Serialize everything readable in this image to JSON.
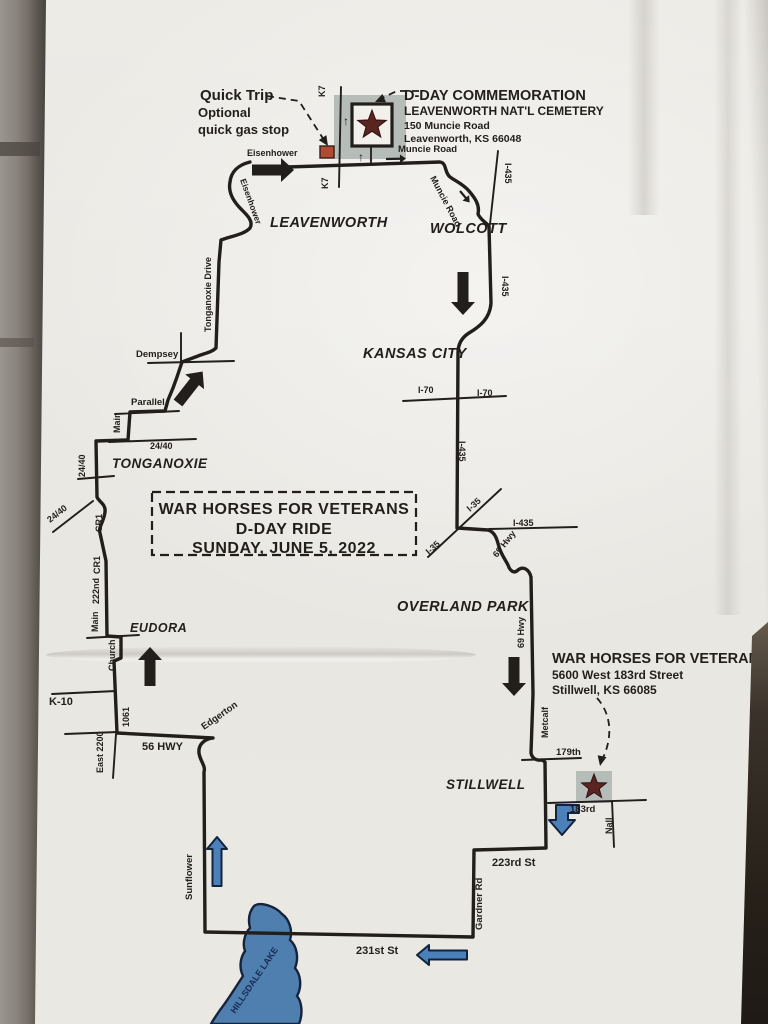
{
  "photo": {
    "wall_color": "#8d8780",
    "paper_color": "#eae8e3",
    "right_edge_dark": "#262019"
  },
  "map": {
    "ink": "#211e1b",
    "accent": {
      "star": "#5a2421",
      "star_outline": "#2c1110",
      "gray_box": "#b6bcb8",
      "orange": "#b04a33",
      "blue": "#4b80b8",
      "blue_outline": "#10243c",
      "lake": "#4e7fae",
      "lake_outline": "#17233d",
      "lake_text": "#1b2a55"
    },
    "title_box": {
      "name": "ride-title-box",
      "x": 152,
      "y": 492,
      "w": 264,
      "h": 63,
      "cx": 284,
      "size": 16,
      "line_y": [
        514,
        534,
        553
      ],
      "lines": [
        "WAR HORSES FOR VETERANS",
        "D-DAY RIDE",
        "SUNDAY, JUNE 5, 2022"
      ]
    },
    "blocks": [
      {
        "name": "quicktrip-note",
        "lines": [
          {
            "t": "Quick Trip",
            "x": 200,
            "y": 100,
            "s": 15
          },
          {
            "t": "Optional",
            "x": 198,
            "y": 117,
            "s": 13
          },
          {
            "t": "quick gas stop",
            "x": 198,
            "y": 134,
            "s": 13
          }
        ]
      },
      {
        "name": "cemetery-info",
        "lines": [
          {
            "t": "D-DAY COMMEMORATION",
            "x": 404,
            "y": 100,
            "s": 14.5
          },
          {
            "t": "LEAVENWORTH NAT'L CEMETERY",
            "x": 404,
            "y": 115,
            "s": 12
          },
          {
            "t": "150 Muncie Road",
            "x": 404,
            "y": 129,
            "s": 10.5
          },
          {
            "t": "Leavenworth, KS 66048",
            "x": 404,
            "y": 142,
            "s": 10.5
          }
        ]
      },
      {
        "name": "warhorses-info",
        "lines": [
          {
            "t": "WAR HORSES FOR VETERANS",
            "x": 552,
            "y": 663,
            "s": 14.5
          },
          {
            "t": "5600 West 183rd Street",
            "x": 552,
            "y": 679,
            "s": 12
          },
          {
            "t": "Stillwell, KS 66085",
            "x": 552,
            "y": 694,
            "s": 12
          }
        ]
      }
    ],
    "route": {
      "name": "main-ride-route",
      "w": 3.4,
      "d": "M 250 162 C 238 165 231 172 230 182 C 228 192 233 201 241 209 C 246 214 254 221 250 228 C 245 234 232 236 221 240 L 219 262 L 216 348 C 212 352 206 353 198 356 L 182 362 L 177 377 L 173 388 L 168 400 L 165 411 L 130 412 L 128 440 L 96 441 L 97 497 C 99 502 106 504 105 512 C 104 522 98 527 100 533 L 106 561 L 107 636 L 121 637 L 121 658 L 114 661 L 117 733 L 213 738 C 205 739 198 744 199 753 C 200 761 206 766 204 772 L 205 932 L 473 937 L 474 850 L 546 848 L 545 762 L 542 760 C 536 761 532 758 531 753 L 533 694 L 531 577 C 529 569 523 566 518 570 C 514 574 510 571 508 565 C 505 559 501 554 499 547 C 497 539 495 532 488 530 L 457 528 L 458 353 C 458 345 461 338 469 333 C 479 327 490 319 491 303 L 489 226 C 485 222 480 219 478 214 C 480 205 475 198 469 191 C 463 184 457 182 450 177 C 444 172 447 163 440 162 L 256 168"
    },
    "roads": [
      {
        "n": "road-k7",
        "d": "M 341 87 L 339 187"
      },
      {
        "n": "road-i435-north",
        "d": "M 498 151 L 490 224"
      },
      {
        "n": "road-dempsey",
        "d": "M 148 363 L 234 361"
      },
      {
        "n": "road-dempsey-stub",
        "d": "M 181 333 L 181 363"
      },
      {
        "n": "road-parallel",
        "d": "M 115 414 L 179 411"
      },
      {
        "n": "road-2440-east",
        "d": "M 109 442 L 196 439"
      },
      {
        "n": "road-2440-tick",
        "d": "M 78 479 L 114 476"
      },
      {
        "n": "road-2440-southwest",
        "d": "M 93 501 L 53 532"
      },
      {
        "n": "road-eudora-tick",
        "d": "M 87 638 L 139 635"
      },
      {
        "n": "road-k10",
        "d": "M 52 694 L 116 691"
      },
      {
        "n": "road-56hwy-west",
        "d": "M 65 734 L 118 732"
      },
      {
        "n": "road-east2200-south",
        "d": "M 116 734 L 113 778"
      },
      {
        "n": "road-i70",
        "d": "M 403 401 L 506 396"
      },
      {
        "n": "road-i35",
        "d": "M 501 489 L 428 557"
      },
      {
        "n": "road-i435-east",
        "d": "M 489 529 L 577 527"
      },
      {
        "n": "road-179th",
        "d": "M 522 760 L 581 758"
      },
      {
        "n": "road-183rd",
        "d": "M 548 803 L 646 800"
      },
      {
        "n": "road-nall",
        "d": "M 612 801 L 614 847"
      }
    ],
    "markers": {
      "cemetery": {
        "gray": [
          334,
          95,
          72,
          64
        ],
        "box": [
          352,
          104,
          40,
          42
        ],
        "star": {
          "cx": 372,
          "cy": 125,
          "r": 15
        },
        "stub": "M 371 146 L 371 165"
      },
      "stillwell": {
        "gray": [
          576,
          771,
          36,
          32
        ],
        "star": {
          "cx": 594,
          "cy": 787,
          "r": 13
        }
      },
      "gas": [
        320,
        146,
        14,
        12
      ]
    },
    "lake": {
      "name": "hillsdale-lake",
      "d": "M 254 906 C 249 912 248 920 250 928 C 245 933 242 943 245 951 C 240 958 239 968 243 976 C 235 988 228 1000 220 1010 C 216 1016 213 1020 211 1024 L 299 1024 C 303 1014 302 1002 297 996 C 302 987 301 975 295 968 C 299 958 297 946 290 940 C 293 930 289 919 282 914 C 276 907 261 901 254 906 Z"
    },
    "dashes": [
      {
        "n": "leader-quicktrip",
        "d": "M 267 96 L 299 101 L 324 140",
        "head": [
          328,
          146,
          57
        ]
      },
      {
        "n": "leader-dday",
        "d": "M 419 91 L 397 91 L 380 99",
        "head": [
          375,
          102,
          157
        ]
      },
      {
        "n": "leader-warhorses",
        "d": "M 597 698 C 613 716 612 740 602 760",
        "head": [
          600,
          766,
          102
        ]
      }
    ],
    "arrows": [
      {
        "n": "arrow-eisenhower-east",
        "kind": "big",
        "x": 252,
        "y": 170,
        "rot": 0,
        "len": 42
      },
      {
        "n": "arrow-i435-south",
        "kind": "big",
        "x": 463,
        "y": 272,
        "rot": 90,
        "len": 43
      },
      {
        "n": "arrow-dempsey-north",
        "kind": "big",
        "x": 178,
        "y": 403,
        "rot": -52,
        "len": 40
      },
      {
        "n": "arrow-eudora-north",
        "kind": "big",
        "x": 150,
        "y": 686,
        "rot": -90,
        "len": 39
      },
      {
        "n": "arrow-69hwy-south",
        "kind": "big",
        "x": 514,
        "y": 657,
        "rot": 90,
        "len": 39
      },
      {
        "n": "arrow-muncie-small",
        "kind": "small",
        "x": 386,
        "y": 159,
        "rot": -1,
        "len": 20
      },
      {
        "n": "arrow-wolcott-small",
        "kind": "small",
        "x": 460,
        "y": 191,
        "rot": 50,
        "len": 15
      },
      {
        "n": "arrow-sunflower-north",
        "kind": "blue",
        "x": 217,
        "y": 886,
        "rot": -90,
        "len": 49
      },
      {
        "n": "arrow-231st-west",
        "kind": "blue",
        "x": 467,
        "y": 955,
        "rot": 180,
        "len": 50
      },
      {
        "n": "arrow-183rd-turn",
        "kind": "bent",
        "d": "M 579 805 L 556 805 L 556 820 L 549 820 L 562 835 L 575 820 L 568 820 L 568 813 L 579 813 Z"
      }
    ],
    "labels": [
      {
        "n": "lbl-eisenhower",
        "t": "Eisenhower",
        "x": 247,
        "y": 156,
        "s": 9
      },
      {
        "n": "lbl-eisenhower-curve",
        "t": "Eisenhower",
        "x": 240,
        "y": 180,
        "s": 8.5,
        "r": 70
      },
      {
        "n": "lbl-k7-top",
        "t": "K7",
        "x": 325,
        "y": 97,
        "s": 9,
        "r": -90
      },
      {
        "n": "lbl-k7-bottom",
        "t": "K7",
        "x": 328,
        "y": 189,
        "s": 9,
        "r": -90
      },
      {
        "n": "lbl-muncie-road",
        "t": "Muncie Road",
        "x": 398,
        "y": 152,
        "s": 9.5
      },
      {
        "n": "lbl-muncie-road-curve",
        "t": "Muncie Road",
        "x": 430,
        "y": 178,
        "s": 9,
        "r": 62
      },
      {
        "n": "lbl-i435-wolcott",
        "t": "I-435",
        "x": 505,
        "y": 163,
        "s": 9,
        "r": 90
      },
      {
        "n": "lbl-i435-mid",
        "t": "I-435",
        "x": 502,
        "y": 276,
        "s": 9,
        "r": 90
      },
      {
        "n": "lbl-leavenworth",
        "t": "LEAVENWORTH",
        "x": 270,
        "y": 227,
        "s": 14.5,
        "i": 1,
        "ls": 0.5
      },
      {
        "n": "lbl-wolcott",
        "t": "WOLCOTT",
        "x": 430,
        "y": 233,
        "s": 14.5,
        "i": 1,
        "ls": 0.5
      },
      {
        "n": "lbl-kansas-city",
        "t": "KANSAS CITY",
        "x": 363,
        "y": 358,
        "s": 14.5,
        "i": 1,
        "ls": 0.5
      },
      {
        "n": "lbl-i70-left",
        "t": "I-70",
        "x": 418,
        "y": 393,
        "s": 9
      },
      {
        "n": "lbl-i70-right",
        "t": "I-70",
        "x": 477,
        "y": 396,
        "s": 9
      },
      {
        "n": "lbl-tonganoxie-drive",
        "t": "Tonganoxie Drive",
        "x": 211,
        "y": 332,
        "s": 9,
        "r": -90
      },
      {
        "n": "lbl-dempsey",
        "t": "Dempsey",
        "x": 136,
        "y": 357,
        "s": 9.5
      },
      {
        "n": "lbl-parallel",
        "t": "Parallel",
        "x": 131,
        "y": 405,
        "s": 9.5
      },
      {
        "n": "lbl-main-tonganoxie",
        "t": "Main",
        "x": 120,
        "y": 433,
        "s": 9,
        "r": -90
      },
      {
        "n": "lbl-2440-east",
        "t": "24/40",
        "x": 150,
        "y": 449,
        "s": 9
      },
      {
        "n": "lbl-tonganoxie",
        "t": "TONGANOXIE",
        "x": 112,
        "y": 468,
        "s": 13.5,
        "i": 1,
        "ls": 0.5
      },
      {
        "n": "lbl-2440-vert",
        "t": "24/40",
        "x": 85,
        "y": 477,
        "s": 9,
        "r": -90
      },
      {
        "n": "lbl-2440-southwest",
        "t": "24/40",
        "x": 50,
        "y": 523,
        "s": 9,
        "r": -38
      },
      {
        "n": "lbl-cr1-upper",
        "t": "CR1",
        "x": 102,
        "y": 532,
        "s": 9,
        "r": -90
      },
      {
        "n": "lbl-cr1-lower",
        "t": "CR1",
        "x": 100,
        "y": 574,
        "s": 9,
        "r": -90
      },
      {
        "n": "lbl-222nd",
        "t": "222nd",
        "x": 99,
        "y": 604,
        "s": 9,
        "r": -90
      },
      {
        "n": "lbl-main-eudora",
        "t": "Main",
        "x": 98,
        "y": 632,
        "s": 9,
        "r": -90
      },
      {
        "n": "lbl-eudora",
        "t": "EUDORA",
        "x": 130,
        "y": 632,
        "s": 12.5,
        "i": 1,
        "ls": 0.5
      },
      {
        "n": "lbl-church",
        "t": "Church",
        "x": 115,
        "y": 671,
        "s": 9,
        "r": -90
      },
      {
        "n": "lbl-k10",
        "t": "K-10",
        "x": 49,
        "y": 705,
        "s": 11
      },
      {
        "n": "lbl-1061",
        "t": "1061",
        "x": 129,
        "y": 727,
        "s": 9,
        "r": -90
      },
      {
        "n": "lbl-east-2200",
        "t": "East 2200",
        "x": 103,
        "y": 773,
        "s": 9,
        "r": -90
      },
      {
        "n": "lbl-56hwy",
        "t": "56 HWY",
        "x": 142,
        "y": 750,
        "s": 11
      },
      {
        "n": "lbl-edgerton",
        "t": "Edgerton",
        "x": 204,
        "y": 730,
        "s": 9.5,
        "r": -35
      },
      {
        "n": "lbl-overland-park",
        "t": "OVERLAND PARK",
        "x": 397,
        "y": 611,
        "s": 14.5,
        "i": 1,
        "ls": 0.5
      },
      {
        "n": "lbl-i435-kc",
        "t": "I-435",
        "x": 459,
        "y": 441,
        "s": 9,
        "r": 90
      },
      {
        "n": "lbl-i35-upper",
        "t": "I-35",
        "x": 470,
        "y": 512,
        "s": 9,
        "r": -42
      },
      {
        "n": "lbl-i35-lower",
        "t": "I-35",
        "x": 429,
        "y": 555,
        "s": 9,
        "r": -42
      },
      {
        "n": "lbl-i435-east",
        "t": "I-435",
        "x": 513,
        "y": 526,
        "s": 9
      },
      {
        "n": "lbl-69hwy-curve",
        "t": "69 Hwy",
        "x": 497,
        "y": 558,
        "s": 9,
        "r": -52
      },
      {
        "n": "lbl-69hwy",
        "t": "69 Hwy",
        "x": 524,
        "y": 648,
        "s": 9,
        "r": -90
      },
      {
        "n": "lbl-stillwell",
        "t": "STILLWELL",
        "x": 446,
        "y": 789,
        "s": 13.5,
        "i": 1,
        "ls": 0.5
      },
      {
        "n": "lbl-metcalf",
        "t": "Metcalf",
        "x": 548,
        "y": 738,
        "s": 9,
        "r": -90
      },
      {
        "n": "lbl-179th",
        "t": "179th",
        "x": 556,
        "y": 755,
        "s": 9.5
      },
      {
        "n": "lbl-183rd",
        "t": "183rd",
        "x": 570,
        "y": 812,
        "s": 9.5
      },
      {
        "n": "lbl-nall",
        "t": "Nall",
        "x": 612,
        "y": 834,
        "s": 9,
        "r": -90
      },
      {
        "n": "lbl-sunflower",
        "t": "Sunflower",
        "x": 192,
        "y": 900,
        "s": 9.5,
        "r": -90
      },
      {
        "n": "lbl-231st",
        "t": "231st St",
        "x": 356,
        "y": 954,
        "s": 11
      },
      {
        "n": "lbl-gardner",
        "t": "Gardner Rd",
        "x": 482,
        "y": 930,
        "s": 9.5,
        "r": -90
      },
      {
        "n": "lbl-223rd",
        "t": "223rd St",
        "x": 492,
        "y": 866,
        "s": 11
      },
      {
        "n": "lbl-hillsdale-lake",
        "t": "HILLSDALE LAKE",
        "x": 235,
        "y": 1014,
        "s": 9,
        "r": -56,
        "c": "#1b2a55"
      },
      {
        "n": "glyph-arrow-up-cemetery",
        "t": "↑",
        "x": 343,
        "y": 125,
        "s": 12
      },
      {
        "n": "glyph-arrow-up-gate",
        "t": "↑",
        "x": 358,
        "y": 161,
        "s": 12
      },
      {
        "n": "glyph-arrow-down-gate",
        "t": "↓",
        "x": 368,
        "y": 161,
        "s": 12
      }
    ]
  }
}
